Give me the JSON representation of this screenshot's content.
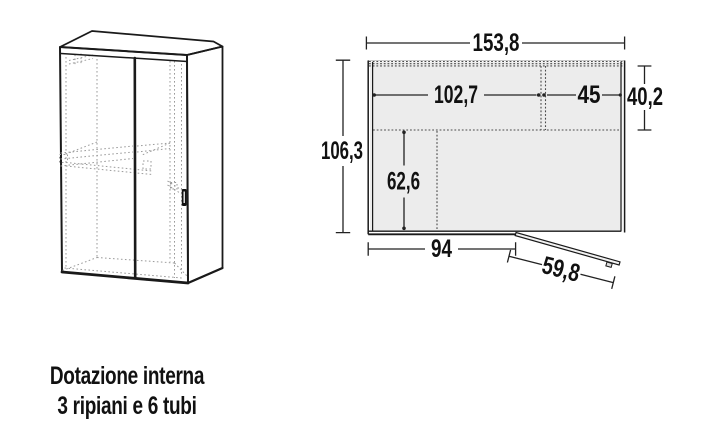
{
  "caption": {
    "line1": "Dotazione interna",
    "line2": "3 ripiani e 6 tubi"
  },
  "plan_dimensions": {
    "overall_width": "153,8",
    "left_interior_width": "102,7",
    "right_interior_width": "45",
    "upper_depth": "40,2",
    "overall_depth": "106,3",
    "lower_interior_depth": "62,6",
    "front_wall_length": "94",
    "open_door_width": "59,8"
  },
  "colors": {
    "panel_fill": "#ececec",
    "front_fill": "#ffffff",
    "outline": "#1a1a1a",
    "hidden_line": "#9a9a9a",
    "dotted_line": "#4a4a4a",
    "dimension_line": "#222222",
    "text": "#111111"
  }
}
